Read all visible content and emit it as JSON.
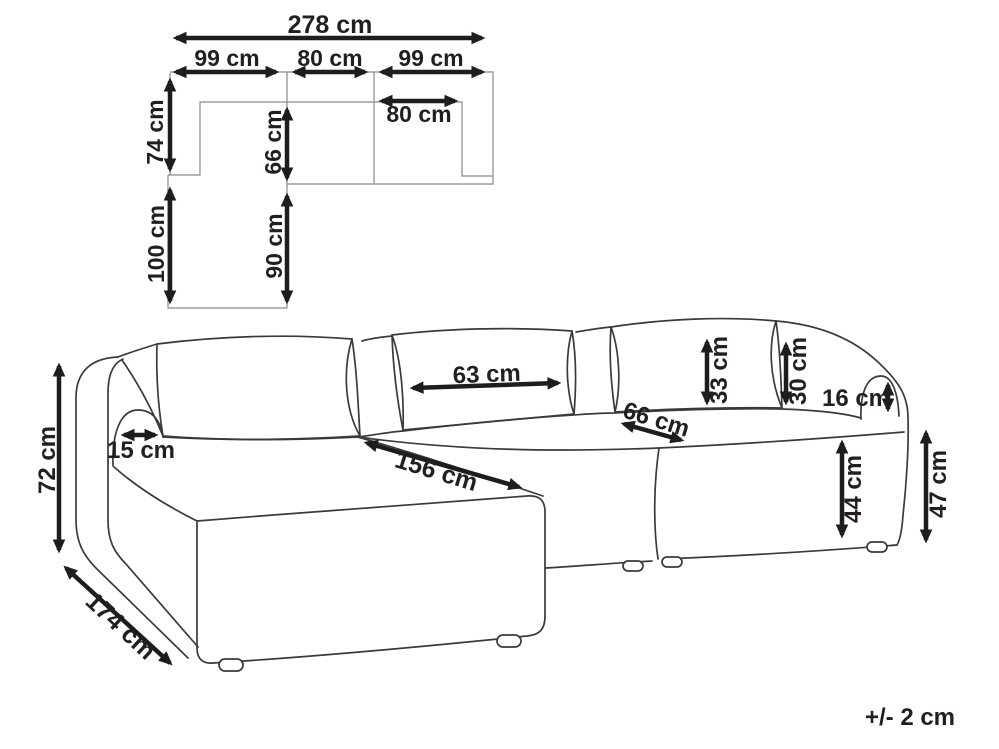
{
  "diagram_type": "sofa dimension drawing",
  "plan_view": {
    "overall_width": "278 cm",
    "left_module_width": "99 cm",
    "middle_module_width": "80 cm",
    "right_module_width": "99 cm",
    "backrest_depth": "74 cm",
    "seat_depth": "66 cm",
    "inner_seat_width": "80 cm",
    "chaise_depth": "100 cm",
    "chaise_seat_depth": "90 cm"
  },
  "front_view": {
    "overall_height": "72 cm",
    "armrest_width": "15 cm",
    "back_cushion_width": "63 cm",
    "chaise_length": "156 cm",
    "seat_depth": "66 cm",
    "back_cushion_height": "33 cm",
    "backrest_height": "30 cm",
    "armrest_above_seat": "16 cm",
    "seat_height": "44 cm",
    "armrest_height": "47 cm",
    "side_depth": "174 cm"
  },
  "note": {
    "tolerance": "+/- 2 cm"
  },
  "colors": {
    "arrow": "#1d1d1d",
    "text": "#231f20",
    "sofa_line": "#3a3a3a",
    "plan_line": "#8a8a8a",
    "background": "#ffffff"
  }
}
